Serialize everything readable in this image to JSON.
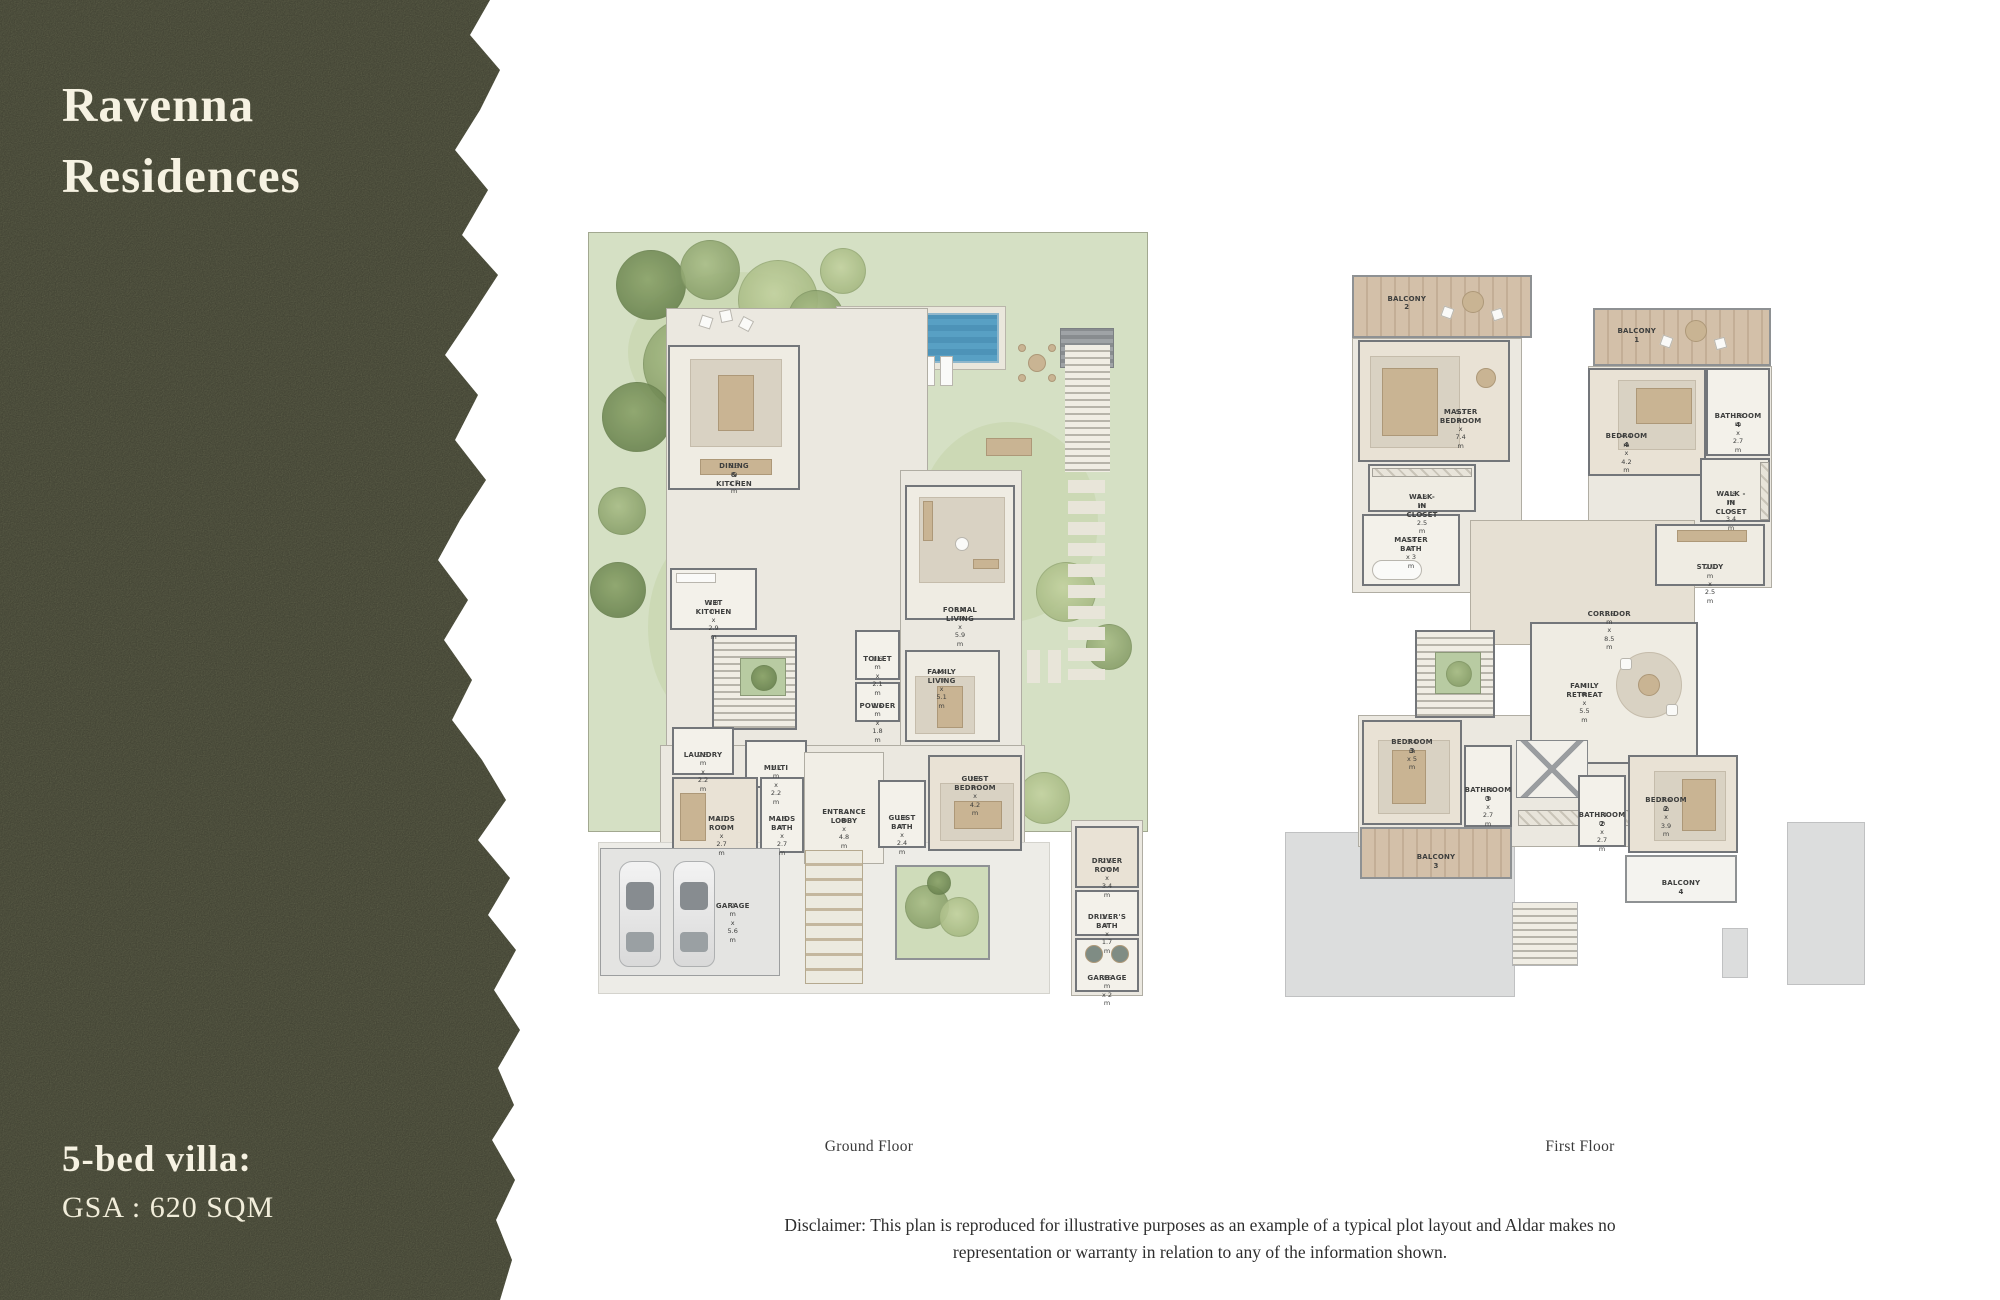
{
  "sidebar": {
    "title_line1": "Ravenna",
    "title_line2": "Residences",
    "villa_type": "5-bed villa:",
    "gsa": "GSA : 620 SQM"
  },
  "captions": {
    "ground": "Ground Floor",
    "first": "First Floor"
  },
  "disclaimer": {
    "line1": "Disclaimer: This plan is reproduced for illustrative purposes as an example of a typical plot layout and Aldar makes no",
    "line2": "representation or warranty in relation to any of the information shown."
  },
  "ground": {
    "rooms": {
      "dining": {
        "label": "DINING & KITCHEN",
        "dims": "5.3 m x 7 m"
      },
      "wet_kitchen": {
        "label": "WET KITCHEN",
        "dims": "3.8 m x 2.9 m"
      },
      "formal_living": {
        "label": "FORMAL LIVING",
        "dims": "6.4 m x 5.9 m"
      },
      "family_living": {
        "label": "FAMILY LIVING",
        "dims": "4.4 m x 5.1 m"
      },
      "toilet": {
        "label": "TOILET",
        "dims": "1.6 m x 2.1 m"
      },
      "powder": {
        "label": "POWDER",
        "dims": "1.6 m x 1.8 m"
      },
      "laundry": {
        "label": "LAUNDRY",
        "dims": "2.5 m x 2.2 m"
      },
      "multi": {
        "label": "MULTI",
        "dims": "2.7 m x 2.2 m"
      },
      "maids_room": {
        "label": "MAIDS ROOM",
        "dims": "3.7 m x 2.7 m"
      },
      "maids_bath": {
        "label": "MAIDS BATH",
        "dims": "1.5 m x 2.7 m"
      },
      "entrance_lobby": {
        "label": "ENTRANCE LOBBY",
        "dims": "3.1 m x 4.8 m"
      },
      "guest_bath": {
        "label": "GUEST BATH",
        "dims": "1.8 m x 2.4 m"
      },
      "guest_bedroom": {
        "label": "GUEST BEDROOM",
        "dims": "3.6 m x 4.2 m"
      },
      "garage": {
        "label": "GARAGE",
        "dims": "7 m x 5.6 m"
      },
      "driver_room": {
        "label": "DRIVER ROOM",
        "dims": "2.5 m x 3.4 m"
      },
      "drivers_bath": {
        "label": "DRIVER'S BATH",
        "dims": "2.5 m x 1.7 m"
      },
      "garbage": {
        "label": "GARBAGE",
        "dims": "2.5 m x 2 m"
      }
    }
  },
  "first": {
    "rooms": {
      "balcony2": {
        "label": "BALCONY 2"
      },
      "master_bedroom": {
        "label": "MASTER BEDROOM",
        "dims": "5.3 m x 7.4 m"
      },
      "wic_master": {
        "label": "WALK-IN CLOSET",
        "dims": "3.8 m x 2.5 m"
      },
      "master_bath": {
        "label": "MASTER BATH",
        "dims": "3.8 m x 3 m"
      },
      "balcony1": {
        "label": "BALCONY 1"
      },
      "bedroom4": {
        "label": "BEDROOM 4",
        "dims": "4.4 m x 4.2 m"
      },
      "bathroom4": {
        "label": "BATHROOM 4",
        "dims": "1.8 m x 2.7 m"
      },
      "wic2": {
        "label": "WALK - IN CLOSET",
        "dims": "1.8 m x 3.4 m"
      },
      "study": {
        "label": "STUDY",
        "dims": "2.9 m x 2.5 m"
      },
      "corridor": {
        "label": "CORRIDOR",
        "dims": "1.6 m x 8.5 m"
      },
      "family_retreat": {
        "label": "FAMILY RETREAT",
        "dims": "4 m x 5.5 m"
      },
      "bedroom3": {
        "label": "BEDROOM 3",
        "dims": "3.4 m x 5 m"
      },
      "bathroom3": {
        "label": "BATHROOM 3",
        "dims": "1.4 m x 2.7 m"
      },
      "balcony3": {
        "label": "BALCONY 3"
      },
      "bathroom2": {
        "label": "BATHROOM 2",
        "dims": "1.4 m x 2.7 m"
      },
      "bedroom2": {
        "label": "BEDROOM 2",
        "dims": "3.6 m x 3.9 m"
      },
      "balcony4": {
        "label": "BALCONY 4"
      }
    }
  },
  "colors": {
    "sidebar_green": "#6b6d54",
    "sidebar_text": "#f6f2e2",
    "garden_green": "#d5e0c4",
    "pool_blue": "#58a0c4",
    "wall_gray": "#73767a",
    "balcony_wood": "#d3c0a9",
    "roof_gray": "#dcdddd"
  }
}
